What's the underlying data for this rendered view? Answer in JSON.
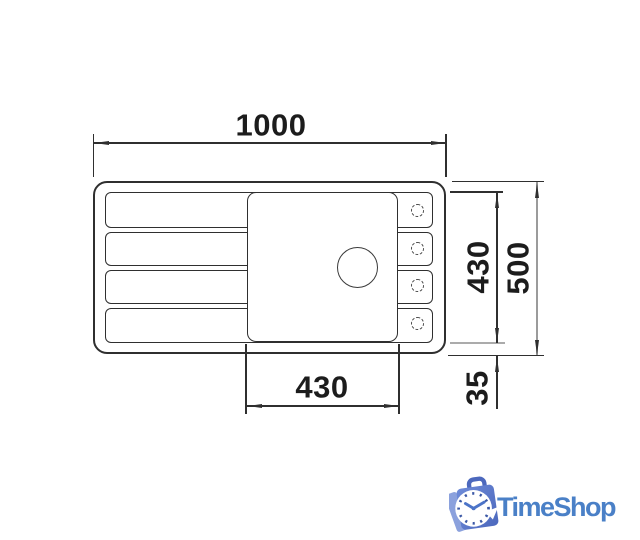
{
  "drawing": {
    "dims": {
      "overall_width": "1000",
      "inner_depth": "430",
      "overall_depth": "500",
      "edge_offset": "35",
      "bowl_width": "430"
    }
  },
  "logo": {
    "brand": "TimeShop",
    "icon": "stopwatch-shopping-bag-icon",
    "brand_color": "#4a80c7"
  },
  "colors": {
    "line": "#2f2f2f",
    "dim_text": "#1c1c1c",
    "gray_reference_line": "#ababab",
    "gray_dim_line": "#9b9b9b",
    "bag_fill": "#5c7ccb",
    "bag_fill_light": "#8ba1dd",
    "bag_fill_dark": "#4c68bd",
    "background": "#ffffff"
  }
}
